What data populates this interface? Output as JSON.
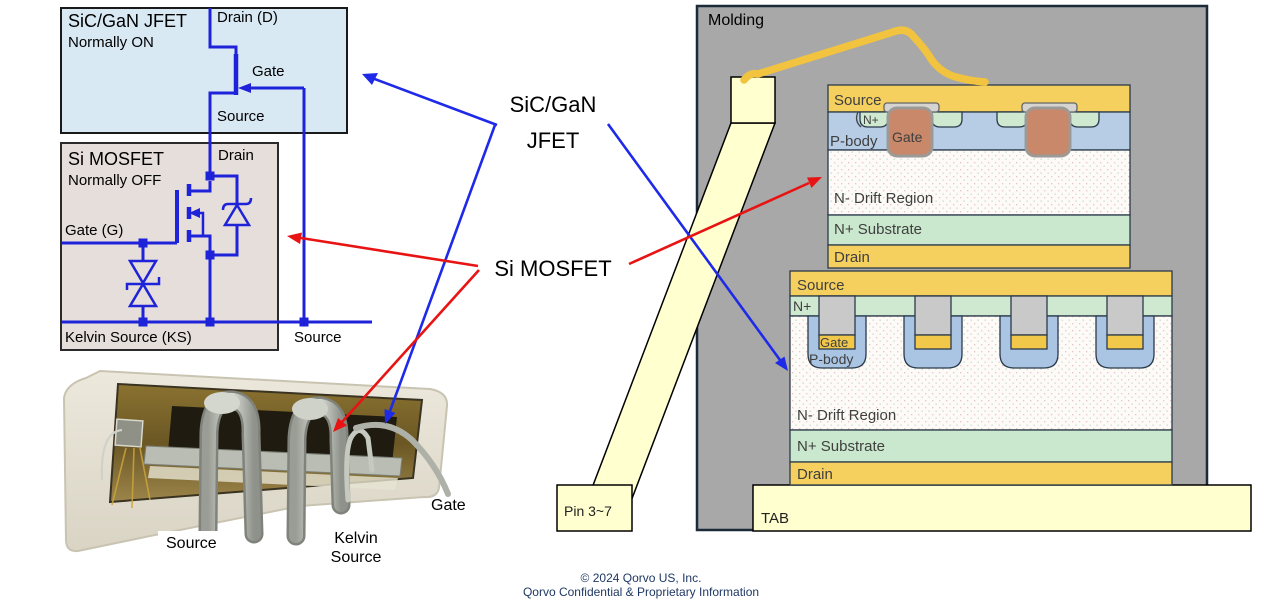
{
  "colors": {
    "circuit_blue": "#1e22d8",
    "arrow_blue": "#1e2ae8",
    "arrow_red": "#e81414",
    "jfet_box_fill": "#d9e9f4",
    "mosfet_box_fill": "#e6dedb",
    "molding_gray": "#a8a8a8",
    "metal_gold": "#f5d05e",
    "pbody_blue": "#b7cde6",
    "nplus_green": "#cfe9d0",
    "substrate_green": "#c9e8cd",
    "gate_brown": "#c9886a",
    "trench_gray": "#c9c9c9",
    "trench_gate_gold": "#f2c84b",
    "pale_yellow": "#ffffcf",
    "bond_wire_gold": "#f2c33e",
    "footer_blue": "#1f3864"
  },
  "jfet_box": {
    "title": "SiC/GaN JFET",
    "subtitle": "Normally ON",
    "drain_label": "Drain (D)",
    "gate_label": "Gate",
    "source_label": "Source"
  },
  "mosfet_box": {
    "title": "Si MOSFET",
    "subtitle": "Normally OFF",
    "drain_label": "Drain",
    "gate_label": "Gate (G)",
    "kelvin_label": "Kelvin Source (KS)",
    "source_label": "Source"
  },
  "center_labels": {
    "jfet_line1": "SiC/GaN",
    "jfet_line2": "JFET",
    "mosfet": "Si MOSFET"
  },
  "package_photo": {
    "source_label": "Source",
    "kelvin_label_line1": "Kelvin",
    "kelvin_label_line2": "Source",
    "gate_label": "Gate"
  },
  "cross_section": {
    "molding_label": "Molding",
    "pin_label": "Pin 3~7",
    "tab_label": "TAB",
    "top_die": {
      "source": "Source",
      "nplus": "N+",
      "pbody": "P-body",
      "gate": "Gate",
      "drift": "N- Drift Region",
      "substrate": "N+ Substrate",
      "drain": "Drain"
    },
    "bottom_die": {
      "source": "Source",
      "nplus": "N+",
      "gate": "Gate",
      "pbody": "P-body",
      "drift": "N- Drift Region",
      "substrate": "N+ Substrate",
      "drain": "Drain"
    }
  },
  "footer": {
    "line1": "© 2024 Qorvo US, Inc.",
    "line2": "Qorvo Confidential & Proprietary Information"
  }
}
